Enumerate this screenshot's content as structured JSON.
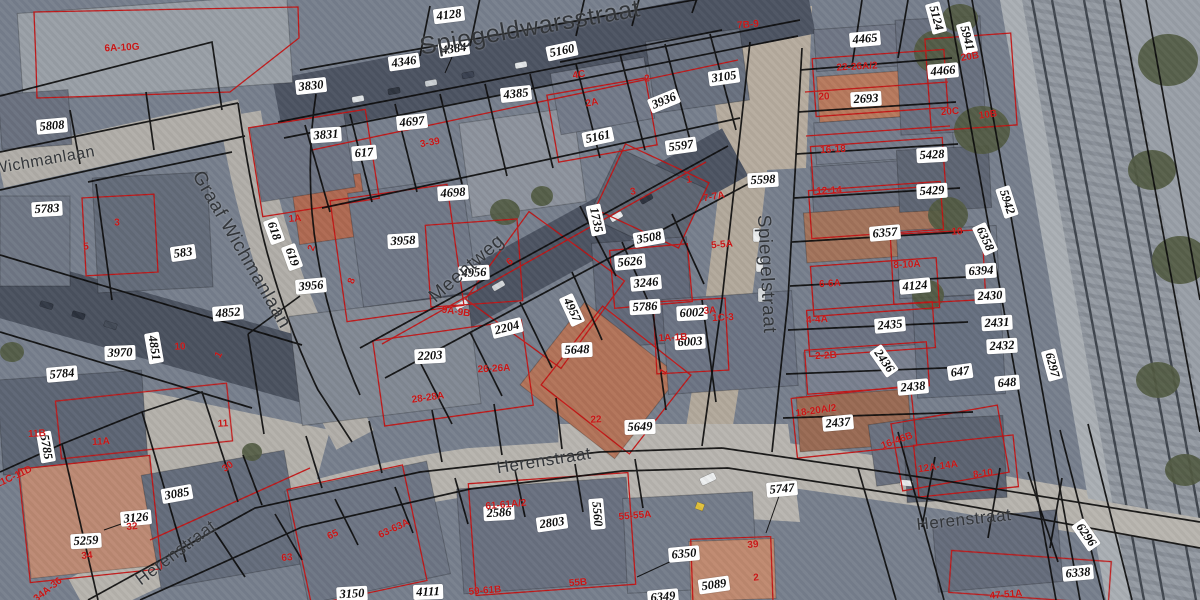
{
  "map": {
    "colors": {
      "parcel_boundary": "#0b0b0b",
      "building_outline": "#c41414",
      "house_number": "#c81616",
      "parcel_label_text": "#0c0c0c",
      "parcel_label_bg": "#ffffff",
      "street_name": "#33363a"
    },
    "street_names": [
      {
        "t": "Spiegeldwarsstraat",
        "x": 530,
        "y": 28,
        "r": -10,
        "s": 25
      },
      {
        "t": "Wichmanlaan",
        "x": 44,
        "y": 161,
        "r": -10,
        "s": 16
      },
      {
        "t": "Graaf Wichmanlaan",
        "x": 241,
        "y": 250,
        "r": 60,
        "s": 19
      },
      {
        "t": "Meentweg",
        "x": 467,
        "y": 269,
        "r": -41,
        "s": 19
      },
      {
        "t": "Spiegelstraat",
        "x": 766,
        "y": 274,
        "r": 87,
        "s": 19
      },
      {
        "t": "Herenstraat",
        "x": 544,
        "y": 461,
        "r": -9,
        "s": 17
      },
      {
        "t": "Herenstraat",
        "x": 176,
        "y": 553,
        "r": -37,
        "s": 17
      },
      {
        "t": "Herenstraat",
        "x": 964,
        "y": 520,
        "r": -6,
        "s": 17
      }
    ],
    "parcel_labels": [
      {
        "t": "5808",
        "x": 52,
        "y": 126,
        "r": -5
      },
      {
        "t": "4128",
        "x": 449,
        "y": 15,
        "r": -7
      },
      {
        "t": "4346",
        "x": 404,
        "y": 62,
        "r": -8
      },
      {
        "t": "4384",
        "x": 454,
        "y": 49,
        "r": -8
      },
      {
        "t": "3830",
        "x": 311,
        "y": 86,
        "r": -6
      },
      {
        "t": "3831",
        "x": 326,
        "y": 135,
        "r": -4
      },
      {
        "t": "617",
        "x": 364,
        "y": 153,
        "r": -5
      },
      {
        "t": "4697",
        "x": 412,
        "y": 122,
        "r": -6
      },
      {
        "t": "4698",
        "x": 453,
        "y": 193,
        "r": -4
      },
      {
        "t": "4385",
        "x": 516,
        "y": 94,
        "r": -6
      },
      {
        "t": "5160",
        "x": 562,
        "y": 51,
        "r": -12
      },
      {
        "t": "5161",
        "x": 598,
        "y": 137,
        "r": -12
      },
      {
        "t": "3936",
        "x": 664,
        "y": 101,
        "r": -22
      },
      {
        "t": "3105",
        "x": 724,
        "y": 77,
        "r": -8
      },
      {
        "t": "5597",
        "x": 681,
        "y": 146,
        "r": -8
      },
      {
        "t": "5598",
        "x": 763,
        "y": 180,
        "r": -3
      },
      {
        "t": "1735",
        "x": 596,
        "y": 220,
        "r": 78
      },
      {
        "t": "3508",
        "x": 649,
        "y": 238,
        "r": -10
      },
      {
        "t": "5626",
        "x": 630,
        "y": 262,
        "r": -5
      },
      {
        "t": "3246",
        "x": 646,
        "y": 283,
        "r": -5
      },
      {
        "t": "5786",
        "x": 645,
        "y": 307,
        "r": -3
      },
      {
        "t": "6002",
        "x": 692,
        "y": 313,
        "r": -3
      },
      {
        "t": "6003",
        "x": 690,
        "y": 342,
        "r": -3
      },
      {
        "t": "5648",
        "x": 577,
        "y": 350,
        "r": -2
      },
      {
        "t": "2204",
        "x": 507,
        "y": 328,
        "r": -14
      },
      {
        "t": "2203",
        "x": 430,
        "y": 356,
        "r": -3
      },
      {
        "t": "4957",
        "x": 572,
        "y": 310,
        "r": 65
      },
      {
        "t": "5649",
        "x": 640,
        "y": 427,
        "r": -2
      },
      {
        "t": "5783",
        "x": 47,
        "y": 209,
        "r": -3
      },
      {
        "t": "583",
        "x": 183,
        "y": 253,
        "r": -8
      },
      {
        "t": "618",
        "x": 274,
        "y": 231,
        "r": 70
      },
      {
        "t": "619",
        "x": 292,
        "y": 257,
        "r": 70
      },
      {
        "t": "3958",
        "x": 403,
        "y": 241,
        "r": -3
      },
      {
        "t": "3956",
        "x": 311,
        "y": 286,
        "r": -5
      },
      {
        "t": "4956",
        "x": 474,
        "y": 273,
        "r": -3
      },
      {
        "t": "5784",
        "x": 62,
        "y": 374,
        "r": -5
      },
      {
        "t": "3970",
        "x": 120,
        "y": 353,
        "r": -2
      },
      {
        "t": "4851",
        "x": 154,
        "y": 348,
        "r": 80
      },
      {
        "t": "4852",
        "x": 228,
        "y": 313,
        "r": -5
      },
      {
        "t": "5785",
        "x": 46,
        "y": 447,
        "r": 80
      },
      {
        "t": "3085",
        "x": 177,
        "y": 494,
        "r": -10
      },
      {
        "t": "3126",
        "x": 136,
        "y": 518,
        "r": -5
      },
      {
        "t": "5259",
        "x": 86,
        "y": 541,
        "r": -3
      },
      {
        "t": "3150",
        "x": 352,
        "y": 594,
        "r": -3
      },
      {
        "t": "4111",
        "x": 428,
        "y": 592,
        "r": -2
      },
      {
        "t": "2586",
        "x": 499,
        "y": 513,
        "r": -3
      },
      {
        "t": "2803",
        "x": 552,
        "y": 523,
        "r": -8
      },
      {
        "t": "5560",
        "x": 597,
        "y": 514,
        "r": 85
      },
      {
        "t": "5747",
        "x": 782,
        "y": 489,
        "r": -5
      },
      {
        "t": "6350",
        "x": 684,
        "y": 554,
        "r": -5
      },
      {
        "t": "5089",
        "x": 714,
        "y": 585,
        "r": -8
      },
      {
        "t": "6349",
        "x": 663,
        "y": 597,
        "r": -5
      },
      {
        "t": "4465",
        "x": 865,
        "y": 39,
        "r": -5
      },
      {
        "t": "2693",
        "x": 866,
        "y": 99,
        "r": -3
      },
      {
        "t": "4466",
        "x": 943,
        "y": 71,
        "r": -5
      },
      {
        "t": "5124",
        "x": 936,
        "y": 18,
        "r": 75
      },
      {
        "t": "5941",
        "x": 967,
        "y": 38,
        "r": 75
      },
      {
        "t": "6357",
        "x": 885,
        "y": 233,
        "r": -5
      },
      {
        "t": "5428",
        "x": 932,
        "y": 155,
        "r": -3
      },
      {
        "t": "5429",
        "x": 932,
        "y": 191,
        "r": -3
      },
      {
        "t": "5942",
        "x": 1007,
        "y": 202,
        "r": 72
      },
      {
        "t": "6358",
        "x": 985,
        "y": 239,
        "r": 65
      },
      {
        "t": "6394",
        "x": 981,
        "y": 271,
        "r": -3
      },
      {
        "t": "2430",
        "x": 990,
        "y": 296,
        "r": -3
      },
      {
        "t": "2431",
        "x": 997,
        "y": 323,
        "r": -3
      },
      {
        "t": "2432",
        "x": 1002,
        "y": 346,
        "r": -3
      },
      {
        "t": "647",
        "x": 960,
        "y": 372,
        "r": -8
      },
      {
        "t": "648",
        "x": 1007,
        "y": 383,
        "r": -5
      },
      {
        "t": "2438",
        "x": 913,
        "y": 387,
        "r": -5
      },
      {
        "t": "6297",
        "x": 1052,
        "y": 365,
        "r": 75
      },
      {
        "t": "2437",
        "x": 838,
        "y": 423,
        "r": -5
      },
      {
        "t": "2435",
        "x": 890,
        "y": 325,
        "r": -5
      },
      {
        "t": "2436",
        "x": 884,
        "y": 361,
        "r": 55
      },
      {
        "t": "4124",
        "x": 915,
        "y": 286,
        "r": -5
      },
      {
        "t": "6296",
        "x": 1086,
        "y": 535,
        "r": 55
      },
      {
        "t": "6338",
        "x": 1078,
        "y": 573,
        "r": -5
      }
    ],
    "house_numbers": [
      {
        "t": "6A-10G",
        "x": 122,
        "y": 48,
        "r": -3
      },
      {
        "t": "7B-9",
        "x": 748,
        "y": 25,
        "r": -5
      },
      {
        "t": "2",
        "x": 647,
        "y": 79,
        "r": -5
      },
      {
        "t": "4C",
        "x": 579,
        "y": 75,
        "r": -10
      },
      {
        "t": "2A",
        "x": 592,
        "y": 103,
        "r": -10
      },
      {
        "t": "3-39",
        "x": 430,
        "y": 143,
        "r": -10
      },
      {
        "t": "20",
        "x": 824,
        "y": 97,
        "r": -3
      },
      {
        "t": "22-26A/2",
        "x": 857,
        "y": 67,
        "r": -3
      },
      {
        "t": "16-18",
        "x": 833,
        "y": 150,
        "r": -3
      },
      {
        "t": "12-14",
        "x": 829,
        "y": 191,
        "r": -3
      },
      {
        "t": "20B",
        "x": 970,
        "y": 57,
        "r": -10
      },
      {
        "t": "20C",
        "x": 950,
        "y": 112,
        "r": -5
      },
      {
        "t": "10B",
        "x": 988,
        "y": 115,
        "r": -8
      },
      {
        "t": "10",
        "x": 957,
        "y": 232,
        "r": -3
      },
      {
        "t": "8-10A",
        "x": 907,
        "y": 265,
        "r": -3
      },
      {
        "t": "6-6A",
        "x": 830,
        "y": 284,
        "r": -3
      },
      {
        "t": "4-4A",
        "x": 817,
        "y": 320,
        "r": -3
      },
      {
        "t": "2-2B",
        "x": 826,
        "y": 356,
        "r": -3
      },
      {
        "t": "18-20A/2",
        "x": 816,
        "y": 411,
        "r": -8
      },
      {
        "t": "16-46B",
        "x": 897,
        "y": 441,
        "r": -20
      },
      {
        "t": "12A-14A",
        "x": 938,
        "y": 467,
        "r": -8
      },
      {
        "t": "8-10",
        "x": 983,
        "y": 474,
        "r": -8
      },
      {
        "t": "47-51A",
        "x": 1006,
        "y": 595,
        "r": -5
      },
      {
        "t": "1A",
        "x": 295,
        "y": 219,
        "r": -5
      },
      {
        "t": "5",
        "x": 86,
        "y": 247,
        "r": -3
      },
      {
        "t": "3",
        "x": 117,
        "y": 223,
        "r": -3
      },
      {
        "t": "2",
        "x": 312,
        "y": 248,
        "r": -70
      },
      {
        "t": "8",
        "x": 352,
        "y": 281,
        "r": -70
      },
      {
        "t": "6",
        "x": 510,
        "y": 262,
        "r": -40
      },
      {
        "t": "3",
        "x": 633,
        "y": 192,
        "r": -10
      },
      {
        "t": "1",
        "x": 689,
        "y": 180,
        "r": -10
      },
      {
        "t": "7-7A",
        "x": 714,
        "y": 197,
        "r": -10
      },
      {
        "t": "5-5A",
        "x": 722,
        "y": 245,
        "r": -5
      },
      {
        "t": "3A",
        "x": 710,
        "y": 311,
        "r": -3
      },
      {
        "t": "1C-3",
        "x": 723,
        "y": 318,
        "r": -3
      },
      {
        "t": "1A-1B",
        "x": 673,
        "y": 338,
        "r": -3
      },
      {
        "t": "1",
        "x": 664,
        "y": 372,
        "r": -60
      },
      {
        "t": "9A-9B",
        "x": 456,
        "y": 312,
        "r": 8
      },
      {
        "t": "26-26A",
        "x": 494,
        "y": 369,
        "r": -3
      },
      {
        "t": "28-28A",
        "x": 428,
        "y": 398,
        "r": -8
      },
      {
        "t": "22",
        "x": 596,
        "y": 420,
        "r": -3
      },
      {
        "t": "11",
        "x": 223,
        "y": 424,
        "r": -3
      },
      {
        "t": "10",
        "x": 180,
        "y": 347,
        "r": -3
      },
      {
        "t": "1",
        "x": 219,
        "y": 355,
        "r": -60
      },
      {
        "t": "11A",
        "x": 101,
        "y": 442,
        "r": -3
      },
      {
        "t": "11B",
        "x": 37,
        "y": 434,
        "r": -3
      },
      {
        "t": "11C-11D",
        "x": 14,
        "y": 477,
        "r": -25
      },
      {
        "t": "30",
        "x": 228,
        "y": 467,
        "r": -35
      },
      {
        "t": "32",
        "x": 132,
        "y": 527,
        "r": -5
      },
      {
        "t": "34",
        "x": 87,
        "y": 556,
        "r": -5
      },
      {
        "t": "34A-36",
        "x": 48,
        "y": 590,
        "r": -38
      },
      {
        "t": "63",
        "x": 287,
        "y": 558,
        "r": -5
      },
      {
        "t": "65",
        "x": 333,
        "y": 535,
        "r": -25
      },
      {
        "t": "63-63A",
        "x": 394,
        "y": 529,
        "r": -25
      },
      {
        "t": "61-61A/2",
        "x": 506,
        "y": 505,
        "r": -5
      },
      {
        "t": "59-61B",
        "x": 485,
        "y": 591,
        "r": -5
      },
      {
        "t": "55B",
        "x": 578,
        "y": 583,
        "r": -5
      },
      {
        "t": "55-55A",
        "x": 635,
        "y": 516,
        "r": -5
      },
      {
        "t": "39",
        "x": 753,
        "y": 545,
        "r": -5
      },
      {
        "t": "2",
        "x": 756,
        "y": 578,
        "r": -5
      }
    ]
  }
}
